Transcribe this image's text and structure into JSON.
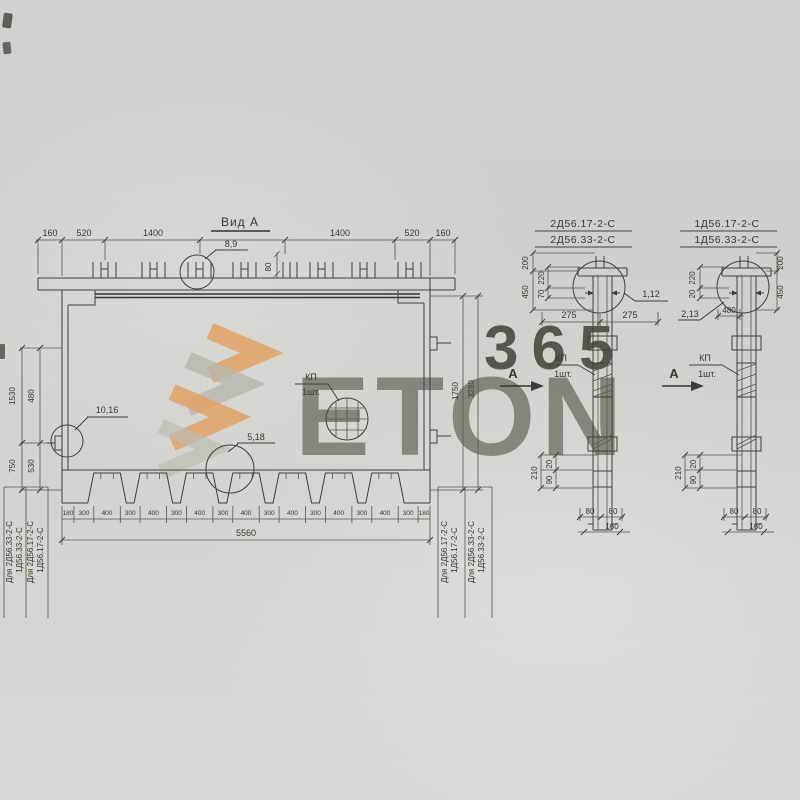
{
  "title": "Вид А",
  "section_marker": "А",
  "watermark": {
    "number": "365",
    "word": "ETON"
  },
  "colors": {
    "paper": "#d3d3cd",
    "ink": "#3c3c35",
    "accent_orange": "#e0923f",
    "wm_gray": "#b2b2aa"
  },
  "main_view": {
    "detail_top": "8,9",
    "detail_left": "10,16",
    "detail_bottom": "5,18",
    "kp": "КП",
    "kp_qty": "1шт.",
    "dim_80": "80",
    "top_dims": [
      "160",
      "520",
      "1400",
      "1400",
      "520",
      "160"
    ],
    "left_dims": [
      "1530",
      "480",
      "750",
      "530"
    ],
    "right_dims": [
      "1750",
      "3280"
    ],
    "tooth_dims": [
      "180",
      "300",
      "400",
      "300",
      "400",
      "300",
      "400",
      "300",
      "400",
      "300",
      "400",
      "300",
      "400",
      "300",
      "400",
      "300",
      "180"
    ],
    "total_width": "5560",
    "left_rows": [
      "Для 2Д56.33-2-С",
      "1Д56.33-2-С",
      "Для 2Д56.17-2-С",
      "1Д56.17-2-С"
    ],
    "right_rows": [
      "Для 2Д56.17-2-С",
      "1Д56.17-2-С",
      "Для 2Д56.33-2-С",
      "1Д56.33-2-С"
    ]
  },
  "side_view_1": {
    "title_1": "2Д56.17-2-С",
    "title_2": "2Д56.33-2-С",
    "detail": "1,12",
    "kp": "КП",
    "kp_qty": "1шт.",
    "dims": {
      "d200": "200",
      "d450": "450",
      "d220": "220",
      "d70": "70",
      "d275l": "275",
      "d275r": "275",
      "d210": "210",
      "d20": "20",
      "d90": "90",
      "d80l": "80",
      "d80r": "80",
      "d160": "160"
    }
  },
  "side_view_2": {
    "title_1": "1Д56.17-2-С",
    "title_2": "1Д56.33-2-С",
    "detail": "2,13",
    "d480": "480",
    "kp": "КП",
    "kp_qty": "1шт.",
    "dims": {
      "d200": "200",
      "d450": "450",
      "d220": "220",
      "d20": "20",
      "d210": "210",
      "db20": "20",
      "d90": "90",
      "d80l": "80",
      "d80r": "80",
      "d160": "160"
    }
  }
}
